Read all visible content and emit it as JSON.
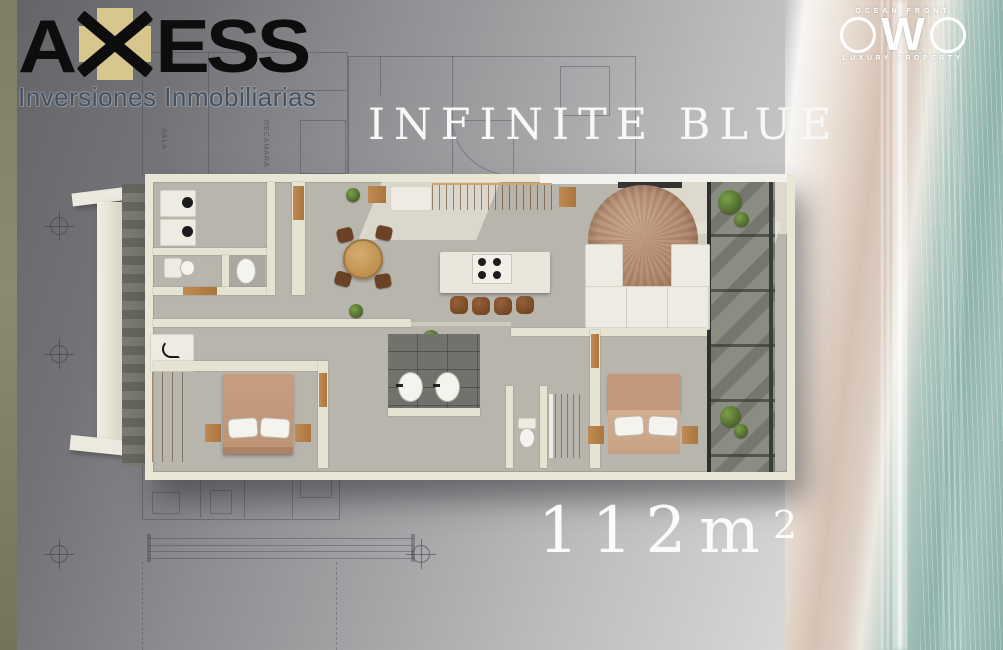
{
  "header": {
    "axess_logo": {
      "letter_a": "A",
      "letters_ess": "ESS",
      "tagline": "Inversiones Inmobiliarias"
    },
    "owo_logo": {
      "top_label": "OCEAN FRONT",
      "letter_w": "W",
      "bottom_label": "LUXURY PROPERTY"
    }
  },
  "title": "INFINITE BLUE",
  "area": {
    "value": "112m",
    "superscript": "2"
  },
  "blueprint_labels": {
    "room1": "SALA",
    "room2": "RECAMARA"
  },
  "palette": {
    "axess_cross": "#d7c68e",
    "axess_text": "#0d0d0d",
    "tagline_text": "#46505e",
    "title_text": "#f8f8f7",
    "background_dark": "#646468",
    "background_light": "#efefef",
    "left_strip": "#83836a",
    "plan_wall": "#eae6d5",
    "plan_floor": "#b7b5ac",
    "wood": "#b5824e",
    "beach_sand": "#d6c2b4",
    "beach_water": "#8fb4ac"
  },
  "floorplan_elements": [
    "entry-frame",
    "laundry-machines",
    "guest-toilet",
    "guest-sink",
    "dining-table",
    "dining-chairs",
    "kitchen-cabinets",
    "kitchen-island",
    "stove",
    "bar-stools",
    "tv-panel",
    "sofa",
    "round-rug",
    "balcony",
    "planters",
    "wardrobe",
    "desk-lamp",
    "bed-1",
    "bed-2",
    "double-vanity",
    "toilet",
    "shower"
  ]
}
